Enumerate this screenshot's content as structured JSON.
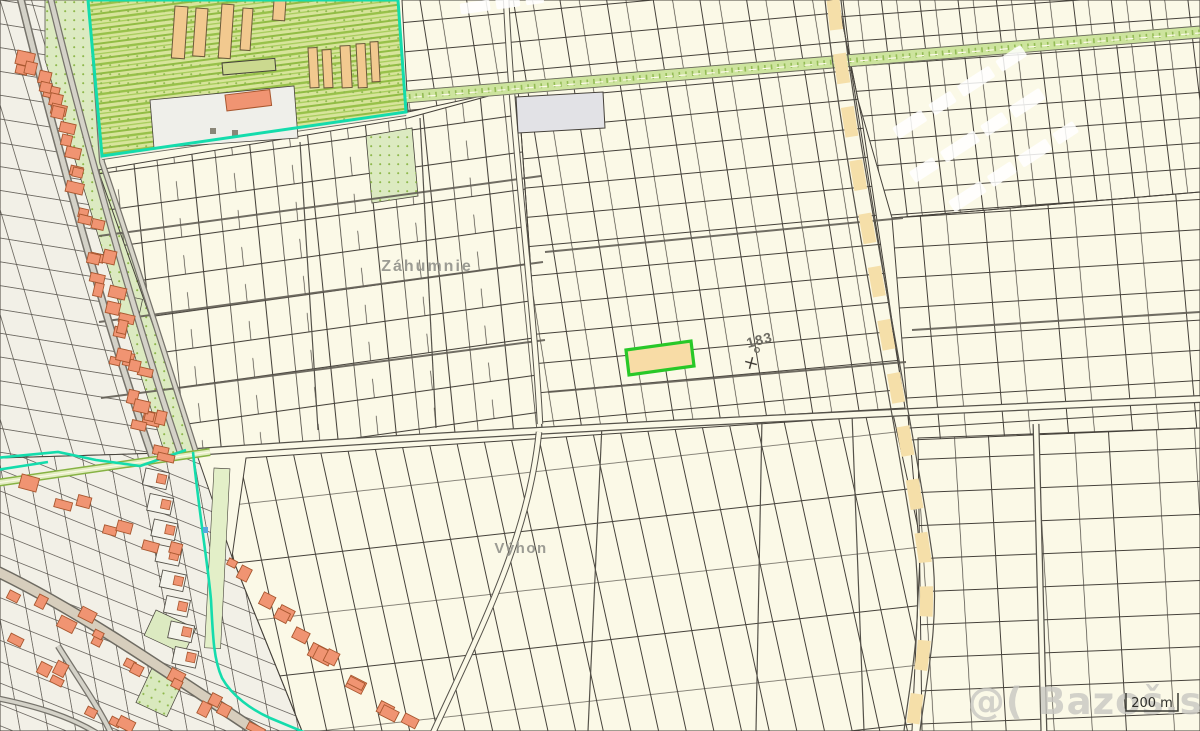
{
  "map": {
    "area_labels": {
      "zahumnie": "Záhumnie",
      "vyhon": "Výhon"
    },
    "parcel": {
      "number": "183"
    },
    "scale_bar": {
      "label": "200 m"
    },
    "watermark": {
      "text": "@( Bazoš.sk"
    },
    "colors": {
      "background": "#FBF9E7",
      "highlight_border": "#28C828",
      "highlight_fill": "#F8DCA6",
      "boundary_teal": "#14DCAC",
      "road_dash": "#F5DFA9",
      "building": "#F09472"
    }
  }
}
